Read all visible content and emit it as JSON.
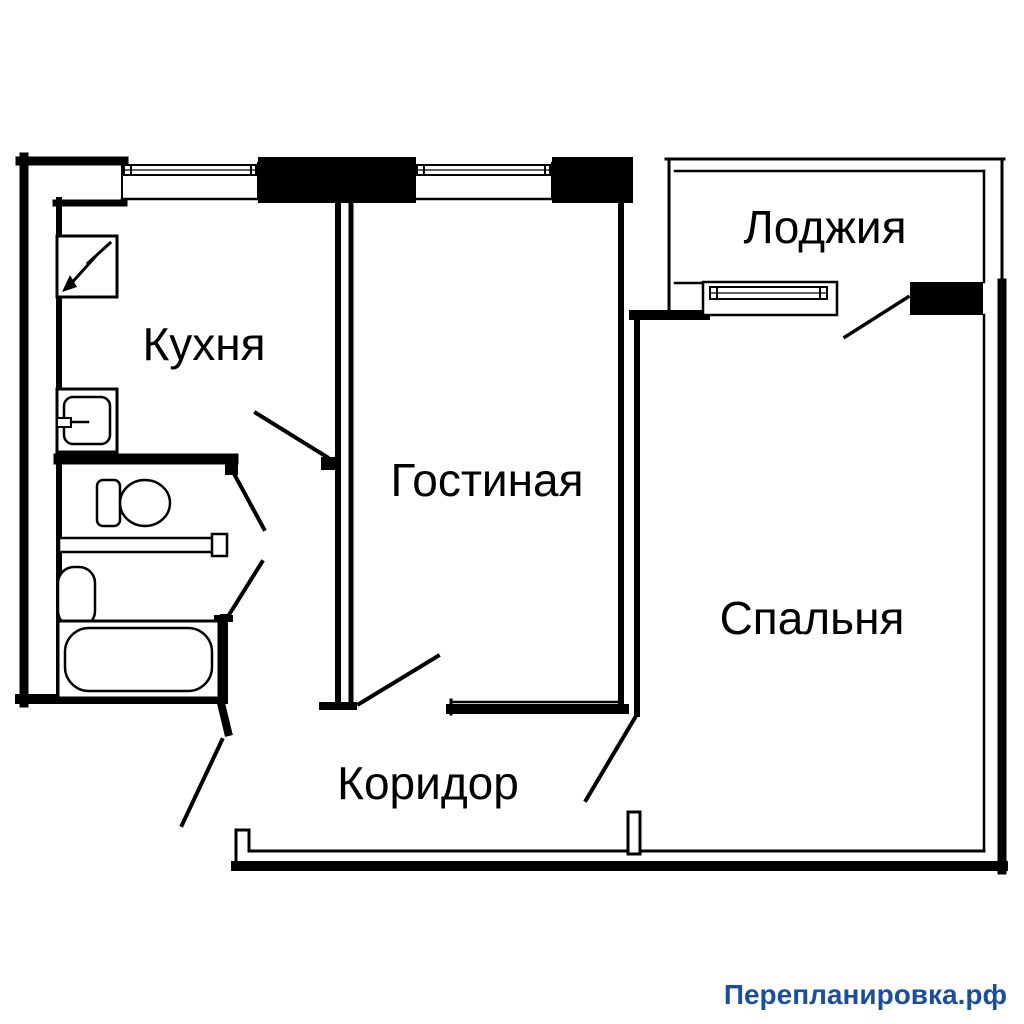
{
  "background": "#ffffff",
  "line_color": "#000000",
  "rooms": {
    "kitchen": {
      "label": "Кухня"
    },
    "living": {
      "label": "Гостиная"
    },
    "bedroom": {
      "label": "Спальня"
    },
    "loggia": {
      "label": "Лоджия"
    },
    "corridor": {
      "label": "Коридор"
    }
  },
  "fixtures": [
    "electric-panel-with-arrow",
    "kitchen-sink",
    "toilet",
    "washbasin",
    "bathtub"
  ],
  "openings": {
    "windows": [
      "kitchen-window",
      "living-room-window",
      "loggia-window"
    ],
    "doors": [
      "kitchen-door",
      "toilet-door",
      "bathroom-door",
      "living-room-door",
      "bedroom-door",
      "balcony-door",
      "entrance-door"
    ]
  },
  "watermark": {
    "text": "Перепланировка.рф",
    "color": "#1b4f9e"
  }
}
